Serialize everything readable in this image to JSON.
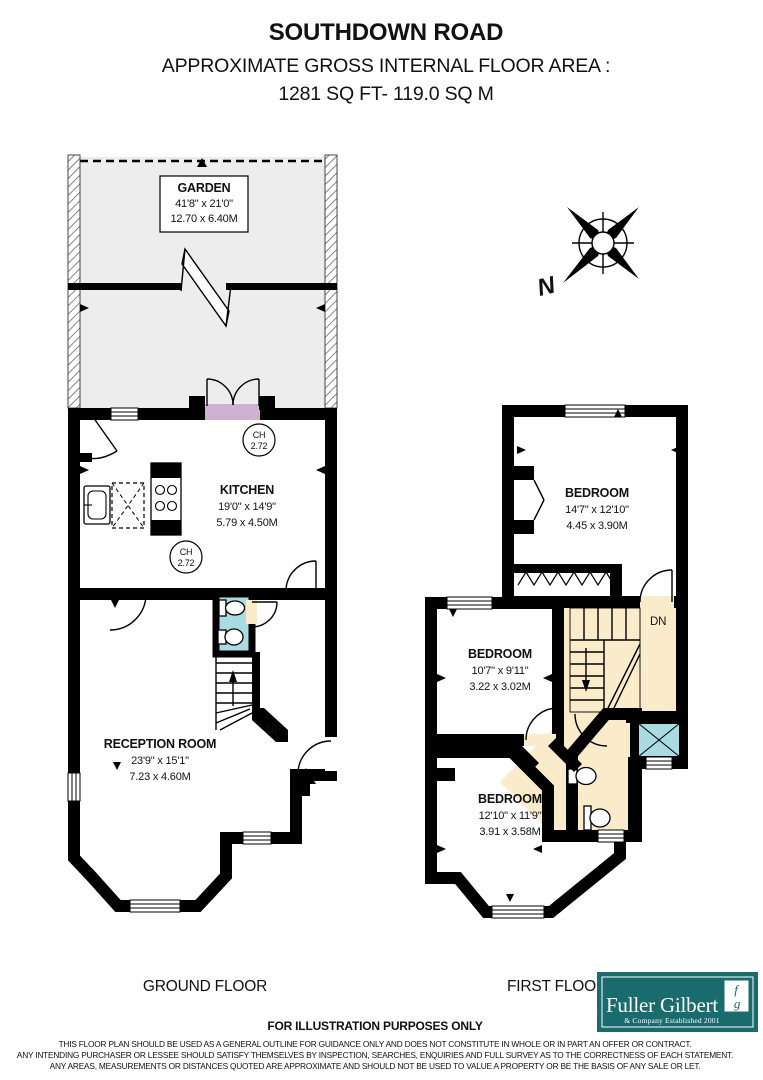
{
  "header": {
    "title": "SOUTHDOWN ROAD",
    "subtitle": "APPROXIMATE GROSS INTERNAL FLOOR AREA :",
    "area": "1281 SQ FT-  119.0 SQ M"
  },
  "compass": {
    "north_label": "N"
  },
  "ground_floor": {
    "label": "GROUND FLOOR",
    "garden": {
      "name": "GARDEN",
      "dim_ft": "41'8\" x 21'0\"",
      "dim_m": "12.70 x 6.40M"
    },
    "kitchen": {
      "name": "KITCHEN",
      "dim_ft": "19'0\" x 14'9\"",
      "dim_m": "5.79 x 4.50M",
      "ch_label": "CH",
      "ch_value": "2.72"
    },
    "reception": {
      "name": "RECEPTION ROOM",
      "dim_ft": "23'9\" x 15'1\"",
      "dim_m": "7.23 x 4.60M"
    },
    "stairs_label": "UP"
  },
  "first_floor": {
    "label": "FIRST FLOOR",
    "bedroom1": {
      "name": "BEDROOM",
      "dim_ft": "14'7\" x 12'10\"",
      "dim_m": "4.45 x 3.90M"
    },
    "bedroom2": {
      "name": "BEDROOM",
      "dim_ft": "10'7\" x 9'11\"",
      "dim_m": "3.22 x 3.02M"
    },
    "bedroom3": {
      "name": "BEDROOM",
      "dim_ft": "12'10\" x 11'9\"",
      "dim_m": "3.91 x 3.58M"
    },
    "stairs_label": "DN"
  },
  "branding": {
    "company": "Fuller Gilbert",
    "tagline": "& Company Established 2001",
    "monogram_top": "f",
    "monogram_bottom": "g",
    "brand_color": "#1a6b6d"
  },
  "footer": {
    "heading": "FOR ILLUSTRATION PURPOSES ONLY",
    "disclaimer1": "THIS FLOOR PLAN SHOULD BE USED AS A GENERAL OUTLINE FOR GUIDANCE ONLY AND DOES NOT CONSTITUTE IN WHOLE OR IN PART AN OFFER OR CONTRACT.",
    "disclaimer2": "ANY INTENDING PURCHASER OR LESSEE SHOULD SATISFY THEMSELVES BY INSPECTION, SEARCHES, ENQUIRIES AND FULL SURVEY AS TO THE CORRECTNESS OF EACH STATEMENT.",
    "disclaimer3": "ANY AREAS, MEASUREMENTS OR DISTANCES QUOTED ARE APPROXIMATE AND SHOULD NOT BE USED TO VALUE A PROPERTY OR BE THE BASIS OF ANY SALE OR LET."
  },
  "colors": {
    "kitchen": "#cfb2d1",
    "bedroom": "#f8dbe9",
    "reception": "#faeccb",
    "bathroom": "#aadbe3",
    "garden": "#ededed",
    "wall": "#000000",
    "brand_teal": "#1a6b6d"
  }
}
